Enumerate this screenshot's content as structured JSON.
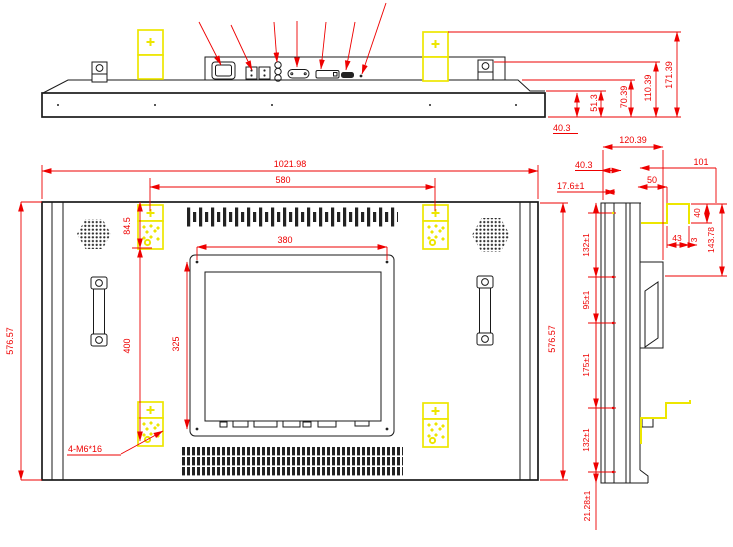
{
  "drawing": {
    "type": "engineering-drawing",
    "units": "mm",
    "colors": {
      "dimension": "#ee0000",
      "bracket_highlight": "#ede600",
      "outline": "#1a1a1a",
      "background": "#ffffff"
    },
    "top_view": {
      "dims": {
        "bezel_thickness": "40.3",
        "back_step": "51.3",
        "cover_height": "70.39",
        "handle_height": "110.39",
        "bracket_height": "171.39"
      }
    },
    "back_view": {
      "dims": {
        "overall_width": "1021.98",
        "bracket_span": "580",
        "plate_width": "380",
        "bracket_top_offset": "84.5",
        "bracket_vertical_span": "400",
        "plate_height": "325",
        "overall_height_left": "576.57",
        "overall_height_right": "576.57"
      },
      "note_mount_screws": "4-M6*16"
    },
    "side_view": {
      "dims": {
        "overall_depth": "120.39",
        "bezel_depth": "40.3",
        "glass_depth": "17.6±1",
        "bracket_inset": "50",
        "bracket_reach": "101",
        "hook_height": "40",
        "hook_depth": "43",
        "hook_gap": "3",
        "bracket_drop": "143.78",
        "hole_pitch_top": "132±1",
        "hole_pitch_upper": "95±1",
        "hole_pitch_middle": "175±1",
        "hole_pitch_lower": "132±1",
        "bottom_offset": "21.28±1"
      }
    }
  }
}
